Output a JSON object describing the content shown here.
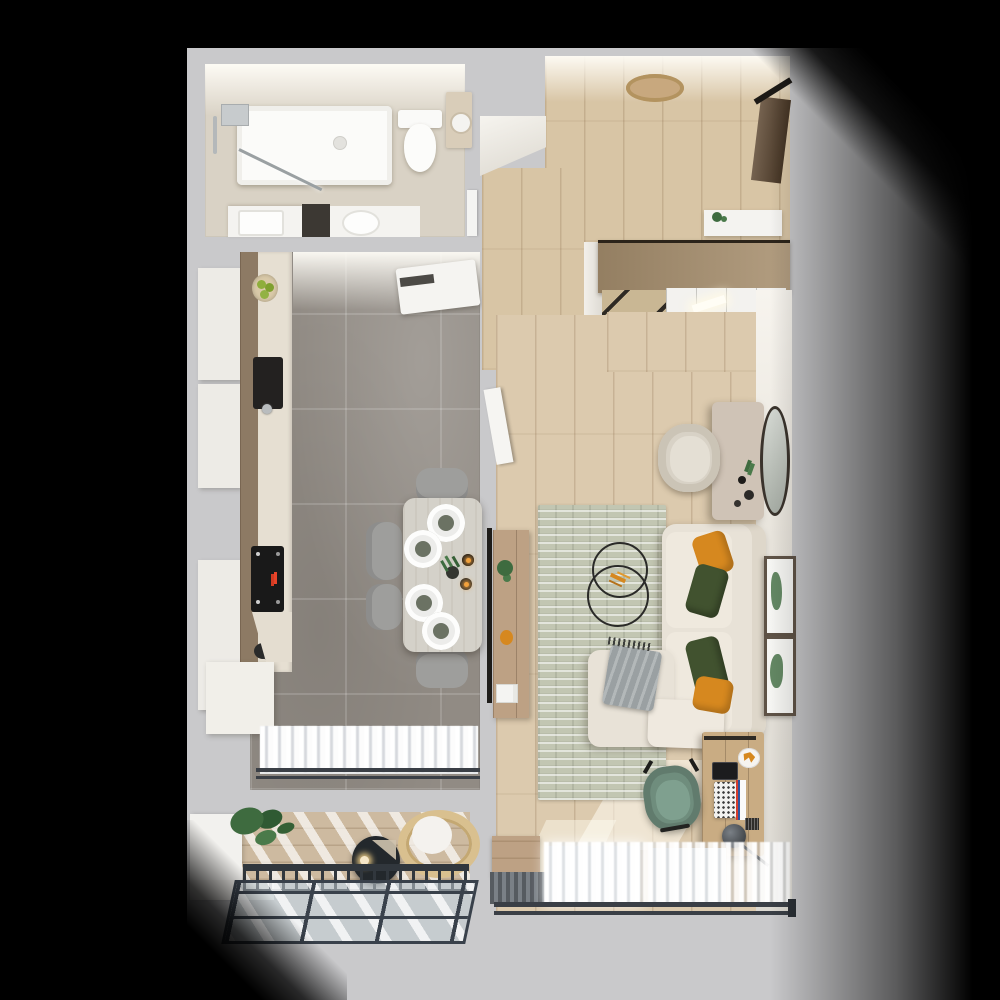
{
  "scene": {
    "description": "top-down 3d architectural render of a one-bedroom apartment floor plan on a gray backdrop with black vignette shadows",
    "background_color": "#c9c9cb",
    "vignette_color": "#000000",
    "palette": {
      "wall_gray": "#c9c9cb",
      "wall_light": "#f2efe9",
      "bathroom_floor": "#d9d2c5",
      "kitchen_floor": "#918b84",
      "kitchen_counter": "#e6dfd2",
      "cabinet_white": "#edebe6",
      "wood_strip": "#8d7a64",
      "hall_floor": "#d8c5a5",
      "living_floor": "#dccaae",
      "balcony_floor": "#cdbaa0",
      "wardrobe_wood": "#a8906f",
      "console_wood": "#bda184",
      "desk_wood": "#c9ac83",
      "dining_table": "#d4d1c9",
      "chair_gray": "#9e9e9c",
      "sofa": "#e8e2d7",
      "ottoman": "#efe9df",
      "pillow_orange": "#d6881f",
      "pillow_green": "#41522f",
      "throw_gray": "#9aa0a2",
      "rug": "#c2c6b2",
      "office_chair_green": "#6f8d7d",
      "vanity_chair": "#d8d2c6",
      "dressing_table": "#cfc3b6",
      "mirror_rim": "#3a332c",
      "plant_green": "#3e6b3f",
      "fruit_green": "#8fae3c",
      "cooktop_black": "#191919",
      "display_red": "#e8442a",
      "curtain_white": "#ffffff",
      "rod_dark": "#3a3f46",
      "railing_dark": "#31373d",
      "glass_blue": "#c2ced3",
      "door_brown": "#5d4731",
      "doormat_tan": "#c8a87e",
      "fixture_white": "#fbfbf9",
      "table_dark": "#23282c"
    },
    "rooms": [
      {
        "id": "bathroom",
        "furniture": [
          "bathtub",
          "shower glass panel",
          "wall shower fixture",
          "toilet",
          "towel cabinet",
          "vanity with sink (left)",
          "washing machine niche",
          "vanity with sink (right)"
        ]
      },
      {
        "id": "kitchen",
        "furniture": [
          "white tall cabinets",
          "wood cabinet strip",
          "counter",
          "fruit bowl",
          "dark sink",
          "induction cooktop with red display",
          "kettle",
          "fridge",
          "peninsula cabinet",
          "sheer window curtains",
          "double curtain rod"
        ]
      },
      {
        "id": "dining-area",
        "furniture": [
          "dining table",
          "four place settings with plates",
          "two candles",
          "small vase with greens",
          "four gray chairs"
        ]
      },
      {
        "id": "hallway",
        "furniture": [
          "round jute doormat",
          "entry door",
          "white shoe cabinet with plant",
          "sliding-door wardrobe",
          "open closet with light"
        ]
      },
      {
        "id": "living-room",
        "furniture": [
          "tv wall strip",
          "wood tv sideboard",
          "plant",
          "orange decor",
          "white books",
          "textured area rug",
          "double-ring chandelier",
          "l-shaped beige sofa",
          "ottoman",
          "two orange pillows",
          "two green pillows",
          "gray throw blanket",
          "two botanical wall prints",
          "dressing table",
          "round wall mirror",
          "beige vanity chair",
          "wood desk",
          "laptop",
          "tablet",
          "desk lamp",
          "orange desk decor",
          "green office chair",
          "low wood cabinet",
          "dark window blinds",
          "sheer curtains",
          "double curtain rod"
        ]
      },
      {
        "id": "balcony",
        "furniture": [
          "potted plant",
          "round dark coffee table with candle",
          "rattan lounge chair",
          "metal railing with balusters",
          "glass roof grid"
        ]
      }
    ]
  }
}
